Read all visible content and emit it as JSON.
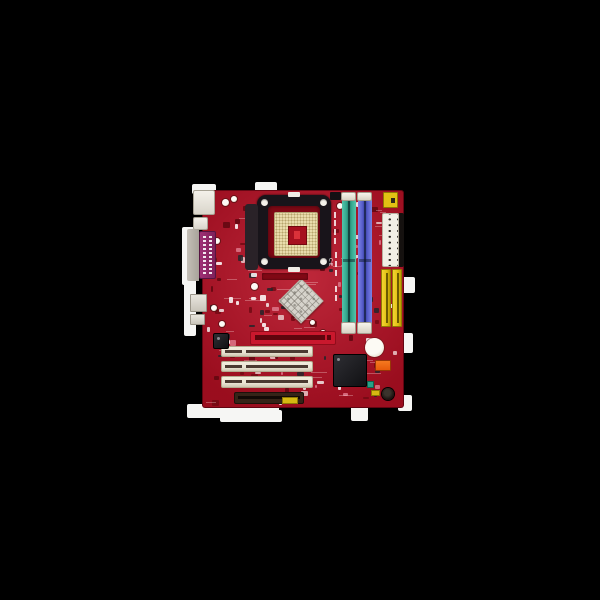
{
  "scene": {
    "type": "product-photo",
    "subject": "red micro-ATX motherboard with Socket 478 retention frame, two DIMM slots, three PCI slots",
    "background": "black canvas with white photo cut-out remnants around the board"
  },
  "silkscreen": {
    "ce_mark": "CE"
  },
  "colors": {
    "canvas_black": "#000000",
    "backdrop_white": "#f6f6f4",
    "pcb_red": "#a91023",
    "pcb_dark": "#7c0a16",
    "frame_black": "#18141a",
    "socket_cream": "#e8dcae",
    "dimm_teal": "#3aa890",
    "dimm_blue": "#5a60c8",
    "slot_cream": "#ebe5d6",
    "connector_yellow": "#e0c11c",
    "port_magenta": "#8c2a68",
    "metal_silver": "#b5b0a8",
    "chip_black": "#1d1d20",
    "orange_accent": "#e25c10",
    "battery_white": "#e8e4d6",
    "brown_connector": "#342419",
    "atx_white": "#f2efe6"
  }
}
